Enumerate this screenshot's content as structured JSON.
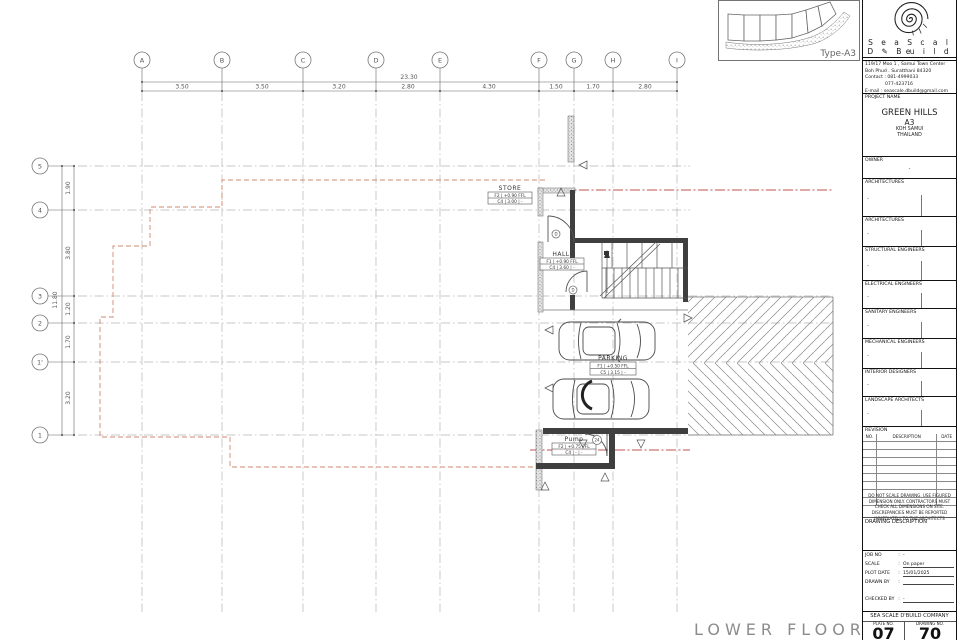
{
  "colors": {
    "accent_red": "#d42a1e",
    "setback_line": "#cf8a6b",
    "property_line": "#c0504d"
  },
  "plan": {
    "title": "LOWER FLOOR PLAN",
    "grid": {
      "cols": [
        "A",
        "B",
        "C",
        "D",
        "E",
        "F",
        "G",
        "H",
        "I"
      ],
      "rows": [
        "5",
        "4",
        "3",
        "2",
        "1'",
        "1"
      ],
      "top_total": "23.30",
      "top_dims": [
        "3.50",
        "3.50",
        "3.20",
        "2.80",
        "4.30",
        "1.50",
        "1.70",
        "2.80"
      ],
      "left_total": "11.80",
      "left_dims": [
        "1.90",
        "3.80",
        "1.20",
        "1.70",
        "3.20"
      ]
    },
    "rooms": {
      "store": {
        "name": "STORE",
        "row1": "F2 | +0.90 FFL",
        "row2": "C4 |  3.00  | -"
      },
      "hall": {
        "name": "HALL",
        "row1": "F1 | +0.90 FFL",
        "row2": "C4 |  3.60  | -"
      },
      "parking": {
        "name": "PARKING",
        "row1": "F1 | +0.50 FFL",
        "row2": "C5 |  3.15  | -"
      },
      "pump": {
        "name": "Pump",
        "row1": "F2 | +0.75 FFL",
        "row2": "C4 |   -   | -"
      }
    },
    "tags": {
      "door": "D",
      "pump": "24"
    }
  },
  "keyplan": {
    "label": "Type-A3"
  },
  "titleblock": {
    "company": {
      "name1": "S e a   S c a l e",
      "name2": "D ✎ B u i l d",
      "address1": "119/17 Moo 1 , Samui Town Center",
      "address2": "Boh Phud . Suratthani 84320",
      "contact": "Contact : 081-4999033",
      "phone2": "077-423716",
      "email": "E-mail : seascale.dbuild@gmail.com"
    },
    "project": {
      "label": "PROJECT NAME",
      "name": "GREEN HILLS",
      "type": "A3",
      "loc1": "KOH  SAMUI",
      "loc2": "THAILAND"
    },
    "owner": {
      "label": "OWNER",
      "value": "-"
    },
    "sections": [
      "ARCHITECTURES",
      "ARCHITECTURES",
      "STRUCTURAL ENGINEERS",
      "ELECTRICAL ENGINEERS",
      "SANITARY ENGINEERS",
      "MECHANICAL ENGINEERS",
      "INTERIOR  DESIGNERS",
      "LANDSCAPE  ARCHITECTS"
    ],
    "revision": {
      "label": "REVISION",
      "col_no": "NO.",
      "col_desc": "DESCRIPTION",
      "col_date": "DATE"
    },
    "note": "DO NOT SCALE DRAWING.  USE FIGURED DIMENSION ONLY.  CONTRACTORS MUST CHECK ALL DIMENSIONS ON SITE.  DISCREPANCIES MUST BE REPORTED IMMEDIATELY TO THE ARCHITECTS",
    "drawing_desc_label": "DRAWING  DESCRIPTION",
    "meta": {
      "sep": ":",
      "job_label": "JOB NO",
      "job": "-",
      "scale_label": "SCALE",
      "scale": "On paper",
      "plot_label": "PLOT DATE",
      "plot": "15/01/2025",
      "drawn_label": "DRAWN BY",
      "drawn": "",
      "checked_label": "CHECKED BY",
      "checked": "-"
    },
    "footer": {
      "company": "SEA  SCALE  D'BUILD  COMPANY",
      "plate_label": "PLATE NO.",
      "drawing_label": "DRAWING NO.",
      "plate_no": "07",
      "drawing_no": "70"
    }
  }
}
